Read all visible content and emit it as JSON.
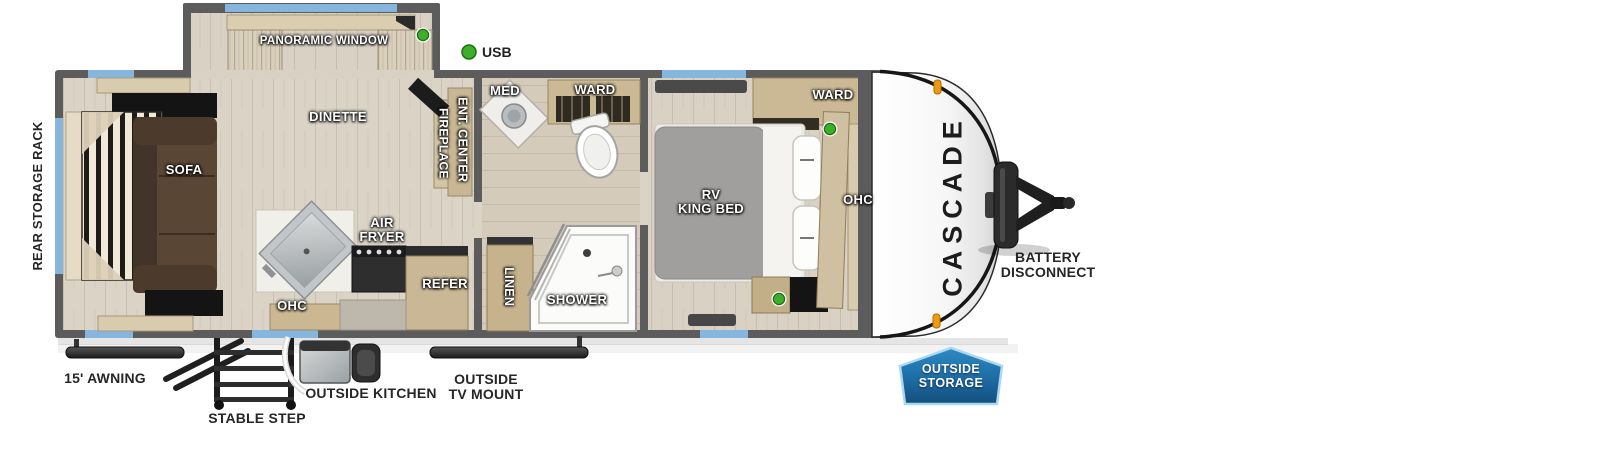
{
  "brand": {
    "name": "CASCADE"
  },
  "legend": {
    "usb": "USB"
  },
  "living": {
    "panoramic_window": "PANORAMIC WINDOW",
    "dinette": "DINETTE",
    "sofa": "SOFA",
    "fireplace": "FIREPLACE",
    "ent_center": "ENT. CENTER"
  },
  "kitchen": {
    "air_fryer": "AIR\nFRYER",
    "ohc": "OHC",
    "refer": "REFER"
  },
  "bathroom": {
    "med": "MED",
    "ward": "WARD",
    "linen": "LINEN",
    "shower": "SHOWER"
  },
  "bedroom": {
    "bed": "RV\nKING BED",
    "ward": "WARD",
    "ohc": "OHC"
  },
  "exterior": {
    "rear_storage_rack": "REAR STORAGE RACK",
    "awning": "15' AWNING",
    "stable_step": "STABLE STEP",
    "outside_kitchen": "OUTSIDE KITCHEN",
    "outside_tv_mount": "OUTSIDE\nTV MOUNT",
    "battery_disconnect": "BATTERY\nDISCONNECT",
    "outside_storage": "OUTSIDE\nSTORAGE"
  },
  "colors": {
    "window_blue": "#86b6de",
    "usb_green": "#3fae2a",
    "badge_blue": "#1f6fa8",
    "marker_orange": "#ef9912",
    "wall_gray": "#5c5c5c"
  }
}
